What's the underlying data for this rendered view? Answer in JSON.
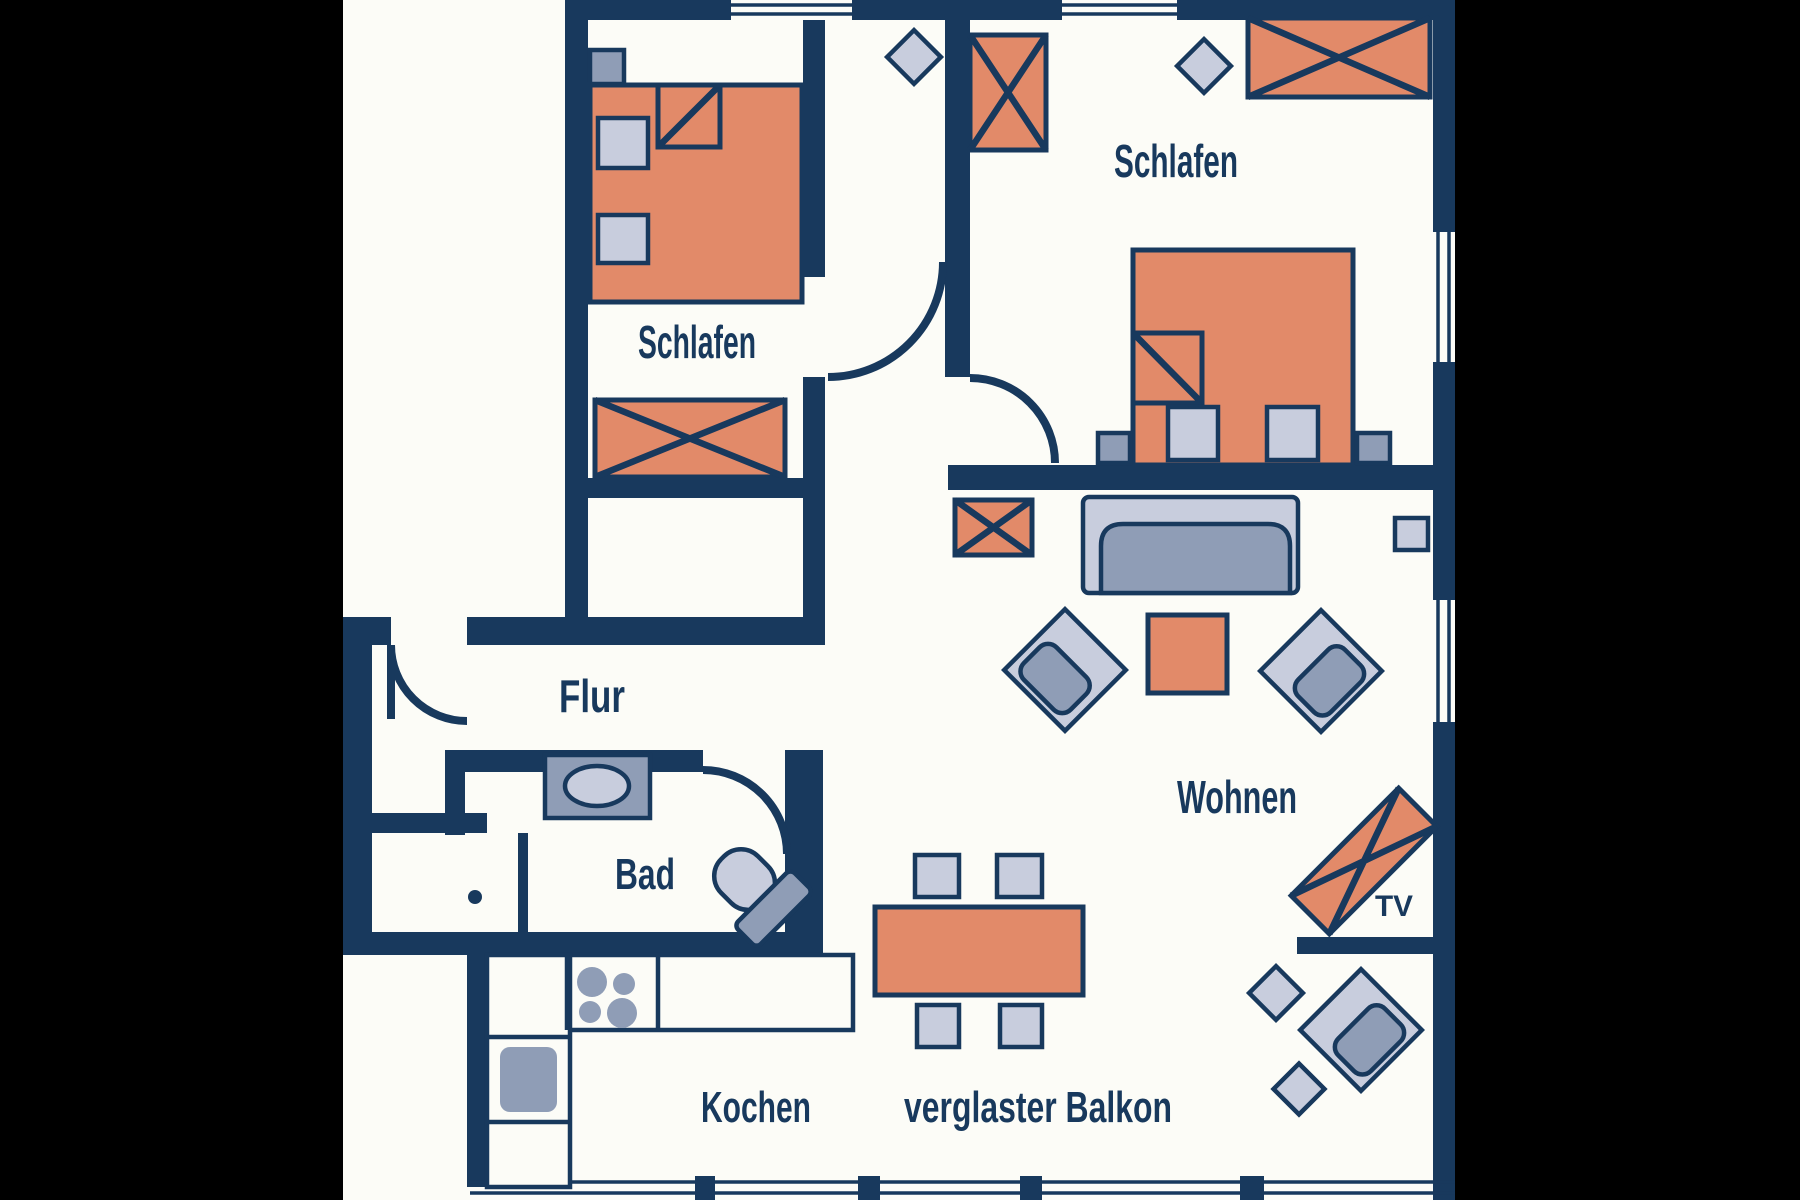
{
  "floorplan": {
    "type": "apartment-floor-plan",
    "labels": {
      "bedroom_left": "Schlafen",
      "bedroom_right": "Schlafen",
      "hallway": "Flur",
      "bathroom": "Bad",
      "living": "Wohnen",
      "kitchen": "Kochen",
      "balcony": "verglaster Balkon",
      "tv": "TV"
    },
    "colors": {
      "wall": "#18395d",
      "furniture_accent": "#e28a69",
      "furniture_light": "#c8cddd",
      "furniture_medium": "#8f9db6",
      "background": "#fcfcf7",
      "outside": "#000000"
    }
  }
}
